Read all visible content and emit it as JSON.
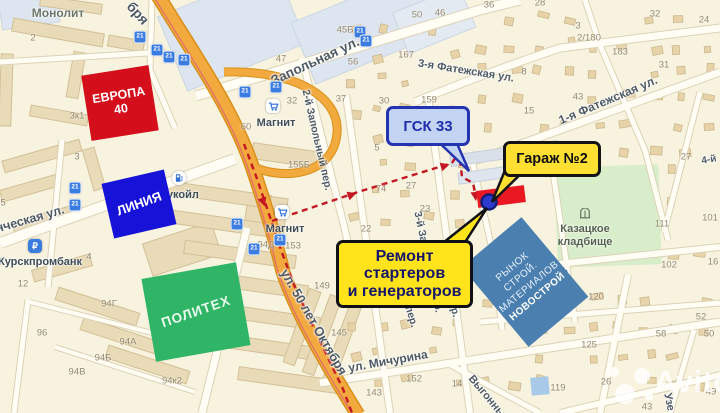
{
  "colors": {
    "route_dash": "#c41723",
    "road_orange": "#f2a93e",
    "marker_blue": "#2b3bd0",
    "garage_highlight": "#ea1822",
    "callout_yellow": "#ffe41c",
    "callout_blue_bg": "#c3d4f2",
    "callout_blue_border": "#2433b0",
    "europa_red": "#d40e1a",
    "liniya_blue": "#1612d8",
    "politeh_green": "#2fb565",
    "novostroy_blue": "#4a7fb0",
    "cemetery_green": "#d8eecb",
    "transit_blue": "#3b7ce0"
  },
  "watermark": {
    "brand": "Avito"
  },
  "transit": {
    "stop_label": "21"
  },
  "callouts": {
    "gsk": {
      "text": "ГСК 33"
    },
    "garage": {
      "text": "Гараж №2"
    },
    "repair": {
      "line1": "Ремонт",
      "line2": "стартеров",
      "line3": "и генераторов"
    }
  },
  "places": {
    "europa_line1": "ЕВРОПА",
    "europa_line2": "40",
    "liniya": "ЛИНИЯ",
    "politeh": "ПОЛИТЕХ",
    "novostroy": {
      "line1": "РЫНОК",
      "line2": "СТРОЙ.",
      "line3": "МАТЕРИАЛОВ",
      "line4": "НОВОСТРОЙ"
    },
    "monolit": "Монолит",
    "lukoil": "Лукойл",
    "magnit1": "Магнит",
    "magnit2": "Магнит",
    "bank": "Курскпромбанк",
    "cemetery_line1": "Казацкое",
    "cemetery_line2": "кладбище"
  },
  "street_labels": [
    {
      "t": "бря",
      "x": 138,
      "y": 13,
      "r": 48,
      "s": 14
    },
    {
      "t": "Запольная ул.",
      "x": 315,
      "y": 61,
      "r": -25,
      "s": 13.5
    },
    {
      "t": "3-я Фатежская ул.",
      "x": 466,
      "y": 71,
      "r": 9,
      "s": 11
    },
    {
      "t": "1-я Фатежская ул.",
      "x": 608,
      "y": 100,
      "r": -23,
      "s": 12
    },
    {
      "t": "2-й Запольный пер.",
      "x": 317,
      "y": 140,
      "r": 77,
      "s": 10.5
    },
    {
      "t": "нческая ул.",
      "x": 30,
      "y": 219,
      "r": -16,
      "s": 12.5
    },
    {
      "t": "ул. 50 лет Октября",
      "x": 314,
      "y": 322,
      "r": 60,
      "s": 13
    },
    {
      "t": "ул. Мичурина",
      "x": 388,
      "y": 361,
      "r": -10,
      "s": 12
    },
    {
      "t": "3-й Запольный пер.",
      "x": 428,
      "y": 262,
      "r": 78,
      "s": 10.5
    },
    {
      "t": "ий пер.",
      "x": 409,
      "y": 309,
      "r": 73,
      "s": 10.5
    },
    {
      "t": "й пер.",
      "x": 452,
      "y": 302,
      "r": 73,
      "s": 10.5
    },
    {
      "t": "Выгонный",
      "x": 489,
      "y": 399,
      "r": 50,
      "s": 11
    },
    {
      "t": "Узе",
      "x": 669,
      "y": 402,
      "r": 78,
      "s": 11
    },
    {
      "t": "4-й",
      "x": 709,
      "y": 160,
      "r": -10,
      "s": 10
    }
  ],
  "house_numbers": [
    {
      "t": "2",
      "x": 33,
      "y": 38
    },
    {
      "t": "100К3",
      "x": 104,
      "y": 78
    },
    {
      "t": "3к1",
      "x": 77,
      "y": 116
    },
    {
      "t": "3",
      "x": 77,
      "y": 157
    },
    {
      "t": "5",
      "x": 3,
      "y": 203
    },
    {
      "t": "45Б",
      "x": 345,
      "y": 30
    },
    {
      "t": "47",
      "x": 281,
      "y": 59
    },
    {
      "t": "50",
      "x": 417,
      "y": 15
    },
    {
      "t": "46",
      "x": 440,
      "y": 13
    },
    {
      "t": "36",
      "x": 489,
      "y": 5
    },
    {
      "t": "28",
      "x": 540,
      "y": 3
    },
    {
      "t": "32",
      "x": 655,
      "y": 14
    },
    {
      "t": "24",
      "x": 704,
      "y": 20
    },
    {
      "t": "3",
      "x": 578,
      "y": 26
    },
    {
      "t": "2/180",
      "x": 589,
      "y": 38
    },
    {
      "t": "183",
      "x": 620,
      "y": 52
    },
    {
      "t": "31",
      "x": 664,
      "y": 65
    },
    {
      "t": "8",
      "x": 524,
      "y": 72
    },
    {
      "t": "43",
      "x": 578,
      "y": 97
    },
    {
      "t": "15",
      "x": 529,
      "y": 111
    },
    {
      "t": "167",
      "x": 406,
      "y": 55
    },
    {
      "t": "56",
      "x": 353,
      "y": 62
    },
    {
      "t": "32",
      "x": 292,
      "y": 101
    },
    {
      "t": "37",
      "x": 341,
      "y": 99
    },
    {
      "t": "30",
      "x": 384,
      "y": 101
    },
    {
      "t": "159",
      "x": 429,
      "y": 100
    },
    {
      "t": "60",
      "x": 246,
      "y": 127
    },
    {
      "t": "155Б",
      "x": 299,
      "y": 165
    },
    {
      "t": "5",
      "x": 377,
      "y": 148
    },
    {
      "t": "74",
      "x": 381,
      "y": 189
    },
    {
      "t": "27",
      "x": 411,
      "y": 186
    },
    {
      "t": "23",
      "x": 425,
      "y": 209
    },
    {
      "t": "22",
      "x": 366,
      "y": 229
    },
    {
      "t": "153",
      "x": 293,
      "y": 246
    },
    {
      "t": "94Д",
      "x": 266,
      "y": 245
    },
    {
      "t": "112",
      "x": 475,
      "y": 261
    },
    {
      "t": "155",
      "x": 433,
      "y": 141
    },
    {
      "t": "157А",
      "x": 455,
      "y": 142
    },
    {
      "t": "27",
      "x": 686,
      "y": 157
    },
    {
      "t": "111",
      "x": 662,
      "y": 224
    },
    {
      "t": "101",
      "x": 710,
      "y": 218
    },
    {
      "t": "102",
      "x": 669,
      "y": 265
    },
    {
      "t": "16",
      "x": 713,
      "y": 262
    },
    {
      "t": "149",
      "x": 322,
      "y": 286
    },
    {
      "t": "145",
      "x": 339,
      "y": 333
    },
    {
      "t": "152",
      "x": 414,
      "y": 379
    },
    {
      "t": "143",
      "x": 374,
      "y": 393
    },
    {
      "t": "14",
      "x": 457,
      "y": 384
    },
    {
      "t": "12",
      "x": 23,
      "y": 284
    },
    {
      "t": "96",
      "x": 42,
      "y": 333
    },
    {
      "t": "94Г",
      "x": 109,
      "y": 304
    },
    {
      "t": "94А",
      "x": 128,
      "y": 342
    },
    {
      "t": "94Б",
      "x": 103,
      "y": 358
    },
    {
      "t": "94В",
      "x": 77,
      "y": 372
    },
    {
      "t": "94к2",
      "x": 172,
      "y": 381
    },
    {
      "t": "4",
      "x": 89,
      "y": 257
    },
    {
      "t": "120",
      "x": 596,
      "y": 297
    },
    {
      "t": "128",
      "x": 544,
      "y": 325
    },
    {
      "t": "125",
      "x": 589,
      "y": 345
    },
    {
      "t": "119",
      "x": 558,
      "y": 388
    },
    {
      "t": "26",
      "x": 606,
      "y": 382
    },
    {
      "t": "49",
      "x": 711,
      "y": 392
    },
    {
      "t": "43",
      "x": 647,
      "y": 407
    },
    {
      "t": "52",
      "x": 701,
      "y": 317
    },
    {
      "t": "58",
      "x": 661,
      "y": 334
    },
    {
      "t": "50",
      "x": 709,
      "y": 334
    }
  ]
}
